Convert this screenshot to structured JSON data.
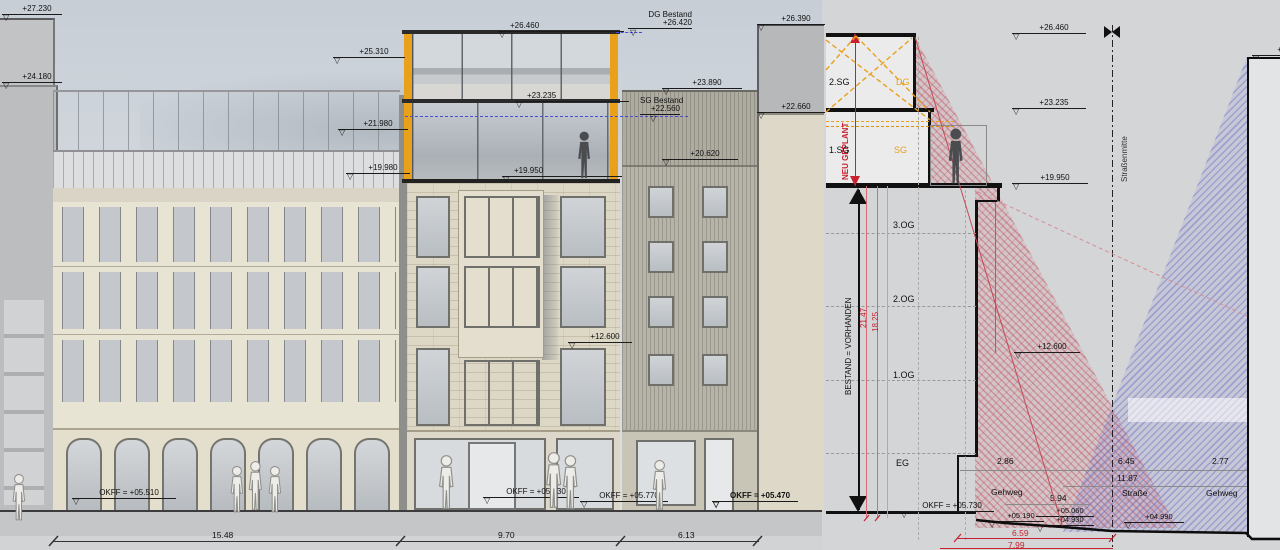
{
  "left_view": {
    "markers": {
      "m27230": "+27.230",
      "m24180": "+24.180",
      "m25310": "+25.310",
      "m21980": "+21.980",
      "m19980": "+19.980",
      "m26460": "+26.460",
      "m23235": "+23.235",
      "m19950": "+19.950",
      "dg_bestand_l1": "DG Bestand",
      "dg_bestand_l2": "+26.420",
      "sg_bestand_l1": "SG Bestand",
      "sg_bestand_l2": "+22.560",
      "m23890": "+23.890",
      "m20620": "+20.620",
      "m26390": "+26.390",
      "m22660": "+22.660",
      "m12600": "+12.600",
      "okff1": "OKFF = +05.510",
      "okff2": "OKFF = +05.730",
      "okff3": "OKFF = +05.770",
      "okff4": "OKFF = +05.470"
    },
    "dims": {
      "d1": "15.48",
      "d2": "9.70",
      "d3": "6.13"
    }
  },
  "section": {
    "floors": {
      "sg2": "2.SG",
      "sg1": "1.SG",
      "og3": "3.OG",
      "og2": "2.OG",
      "og1": "1.OG",
      "eg": "EG"
    },
    "roof": {
      "dg": "DG",
      "sg": "SG"
    },
    "labels": {
      "neu": "NEU GEPLANT",
      "bestand": "BESTAND = VORHANDEN",
      "strassenmitte": "Straßenmitte"
    },
    "markers": {
      "m26460": "+26.460",
      "m23235": "+23.235",
      "m19950": "+19.950",
      "m12600": "+12.600",
      "okff": "OKFF = +05.730",
      "m05190": "+05.190",
      "m05060": "+05.060",
      "m04930": "+04.930",
      "m04990": "+04.990",
      "m25": "+25"
    },
    "red_dims": {
      "h1": "21.47",
      "h2": "18.25",
      "w1": "6.59",
      "w2": "7.99"
    },
    "street": {
      "gehweg_l": "Gehweg",
      "strasse": "Straße",
      "gehweg_r": "Gehweg",
      "d_gl": "2.86",
      "d_s": "6.45",
      "d_gr": "2.77",
      "d_street": "11.87",
      "d_half": "5.94"
    }
  },
  "colors": {
    "accent_orange": "#E9A11B",
    "neu_red": "#C8202F",
    "bestand_blue": "#4A4AD2",
    "red_hatch": "#C04050",
    "blue_hatch": "#6A6AC8"
  }
}
